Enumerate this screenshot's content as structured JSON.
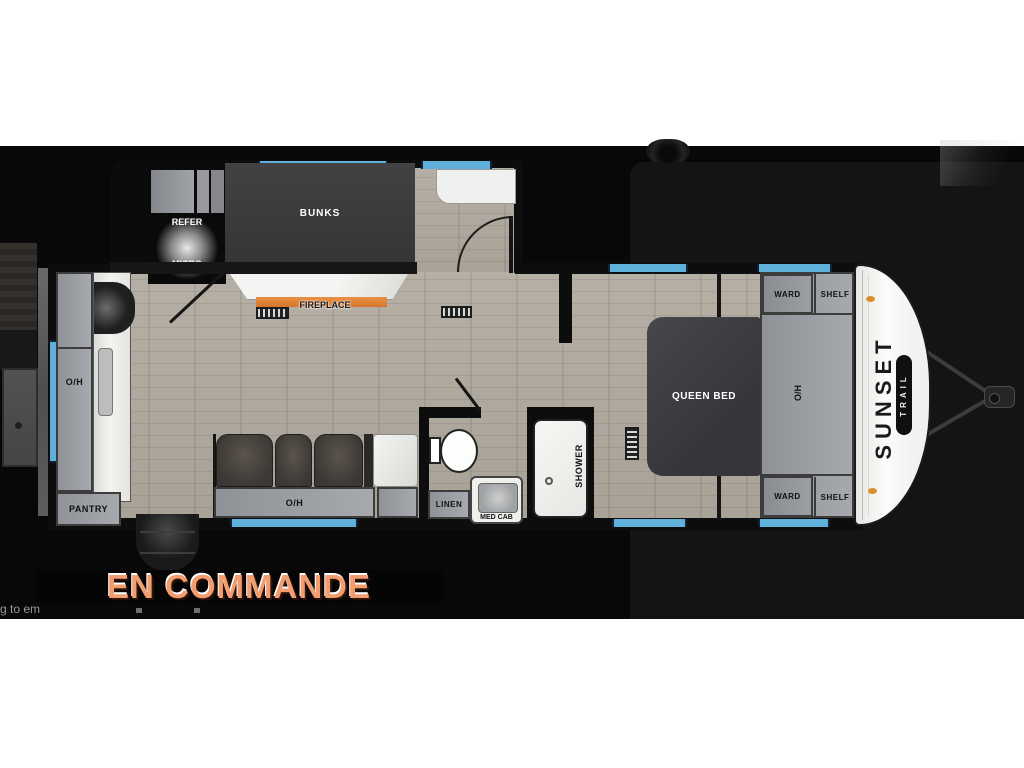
{
  "status_banner": {
    "label": "EN COMMANDE"
  },
  "partial_text": "g to em",
  "brand": {
    "model": "SUNSET",
    "sub": "TRAIL"
  },
  "rooms": {
    "bunks": "BUNKS",
    "refer": "REFER",
    "micro": "MICRO",
    "fireplace": "FIREPLACE",
    "overhead": "O/H",
    "pantry": "PANTRY",
    "linen": "LINEN",
    "med_cab": "MED CAB",
    "shower": "SHOWER",
    "queen_bed": "QUEEN BED",
    "ward": "WARD",
    "shelf": "SHELF"
  },
  "colors": {
    "window_blue": "#5fb0da",
    "fireplace_orange": "#df8136",
    "status_orange": "#f29d70",
    "floor_wood": "#b1aa9f",
    "cabinet_gray": "#9b9ea2",
    "cap_white": "#f6f6f4"
  }
}
